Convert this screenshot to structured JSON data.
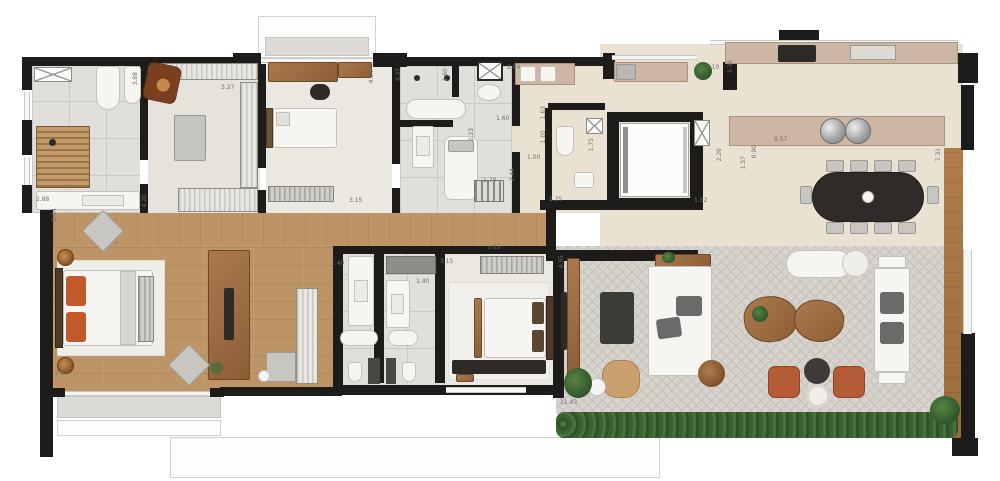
{
  "plan": {
    "type": "residential-apartment-floor-plan",
    "units": "meters",
    "dimension_labels": [
      {
        "text": "2.88",
        "x": 36,
        "y": 196,
        "vertical": false
      },
      {
        "text": "5.14",
        "x": 51,
        "y": 208,
        "vertical": true
      },
      {
        "text": "4.20",
        "x": 141,
        "y": 194,
        "vertical": true
      },
      {
        "text": "3.88",
        "x": 132,
        "y": 72,
        "vertical": true
      },
      {
        "text": "3.27",
        "x": 221,
        "y": 84,
        "vertical": false
      },
      {
        "text": "4.04",
        "x": 368,
        "y": 70,
        "vertical": true
      },
      {
        "text": "3.15",
        "x": 349,
        "y": 197,
        "vertical": false
      },
      {
        "text": "3.37",
        "x": 395,
        "y": 68,
        "vertical": true
      },
      {
        "text": "1.60",
        "x": 442,
        "y": 68,
        "vertical": true
      },
      {
        "text": "1.60",
        "x": 496,
        "y": 115,
        "vertical": false
      },
      {
        "text": "2.84",
        "x": 507,
        "y": 64,
        "vertical": false
      },
      {
        "text": "2.23",
        "x": 468,
        "y": 128,
        "vertical": true
      },
      {
        "text": "1.70",
        "x": 483,
        "y": 177,
        "vertical": false
      },
      {
        "text": "2.44",
        "x": 509,
        "y": 168,
        "vertical": true
      },
      {
        "text": "1.00",
        "x": 527,
        "y": 154,
        "vertical": false
      },
      {
        "text": "1.63",
        "x": 540,
        "y": 106,
        "vertical": true
      },
      {
        "text": "1.05",
        "x": 540,
        "y": 130,
        "vertical": true
      },
      {
        "text": "1.75",
        "x": 588,
        "y": 138,
        "vertical": true
      },
      {
        "text": "1.25",
        "x": 549,
        "y": 196,
        "vertical": false
      },
      {
        "text": "1.52",
        "x": 694,
        "y": 197,
        "vertical": false
      },
      {
        "text": "3.10",
        "x": 706,
        "y": 64,
        "vertical": false
      },
      {
        "text": "3.38",
        "x": 727,
        "y": 60,
        "vertical": true
      },
      {
        "text": "2.26",
        "x": 716,
        "y": 148,
        "vertical": true
      },
      {
        "text": "0.90",
        "x": 751,
        "y": 145,
        "vertical": true
      },
      {
        "text": "1.57",
        "x": 740,
        "y": 156,
        "vertical": true
      },
      {
        "text": "8.57",
        "x": 774,
        "y": 136,
        "vertical": false
      },
      {
        "text": "7.31",
        "x": 935,
        "y": 148,
        "vertical": true
      },
      {
        "text": "4.95",
        "x": 558,
        "y": 255,
        "vertical": true
      },
      {
        "text": "3.05",
        "x": 487,
        "y": 244,
        "vertical": false
      },
      {
        "text": "3.15",
        "x": 440,
        "y": 258,
        "vertical": false
      },
      {
        "text": "1.40",
        "x": 331,
        "y": 260,
        "vertical": false
      },
      {
        "text": "1.40",
        "x": 416,
        "y": 278,
        "vertical": false
      },
      {
        "text": "7.57",
        "x": 55,
        "y": 370,
        "vertical": false
      },
      {
        "text": "11.43",
        "x": 560,
        "y": 399,
        "vertical": false
      }
    ]
  },
  "colors": {
    "wall": "#1d1c1a",
    "window": "#c9c8c4",
    "wood_floor": "#bd9465",
    "tile_floor": "#e0dfdb",
    "tile_line": "#cac9c5",
    "carpet_floor": "#eae8e1",
    "social_floor": "#e9e2d3",
    "terrace_floor": "#d7d3cd",
    "terrace_line": "#c6c1ba",
    "counter": "#cdb6a4",
    "furniture_white": "#f6f5f2",
    "dark_furniture": "#2e2b27",
    "wood_furniture": "#9a6a41",
    "rust": "#b45c35",
    "orange_pillow": "#c05a2a",
    "hedge_green": "#33582b",
    "label_text": "#6f6e6a",
    "slab": "#dbdad6"
  }
}
